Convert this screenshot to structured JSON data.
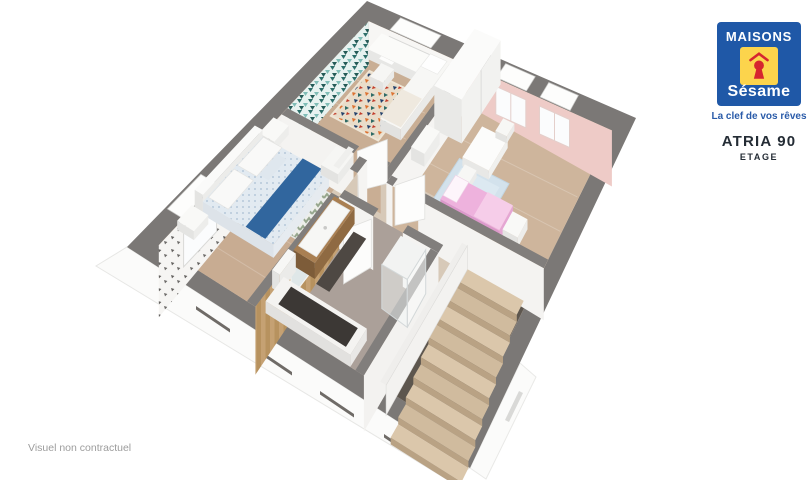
{
  "branding": {
    "name_top": "MAISONS",
    "name_bottom": "Sésame",
    "tagline": "La clef de vos rêves"
  },
  "plan": {
    "model": "ATRIA 90",
    "level": "ETAGE"
  },
  "footer": {
    "disclaimer": "Visuel non contractuel"
  },
  "colors": {
    "brand_blue": "#1f58a7",
    "brand_yellow": "#fcd44c",
    "brand_red": "#d6252f",
    "tagline_blue": "#2a5ba9",
    "text_dark": "#242c35",
    "caption_gray": "#9c9c9c",
    "wall_gray": "#7b7876",
    "inner_wall_gray": "#817e7c",
    "floor_wood": "#cdb49b",
    "floor_hall": "#d7c9b8",
    "floor_bath": "#aba099",
    "stair_wood": "#dbc7ab",
    "wallpaper_teal": "#2d6f6a",
    "wallpaper_motif": "#62605e",
    "wall_pink": "#eecbc7",
    "facade_white": "#fbfbfa",
    "bed_blue": "#31669e",
    "bed_pink": "#eeb2dd",
    "rug_blue": "#d3e2ec",
    "vanity_wood": "#a97f52",
    "toy_blue": "#4a90d9"
  }
}
